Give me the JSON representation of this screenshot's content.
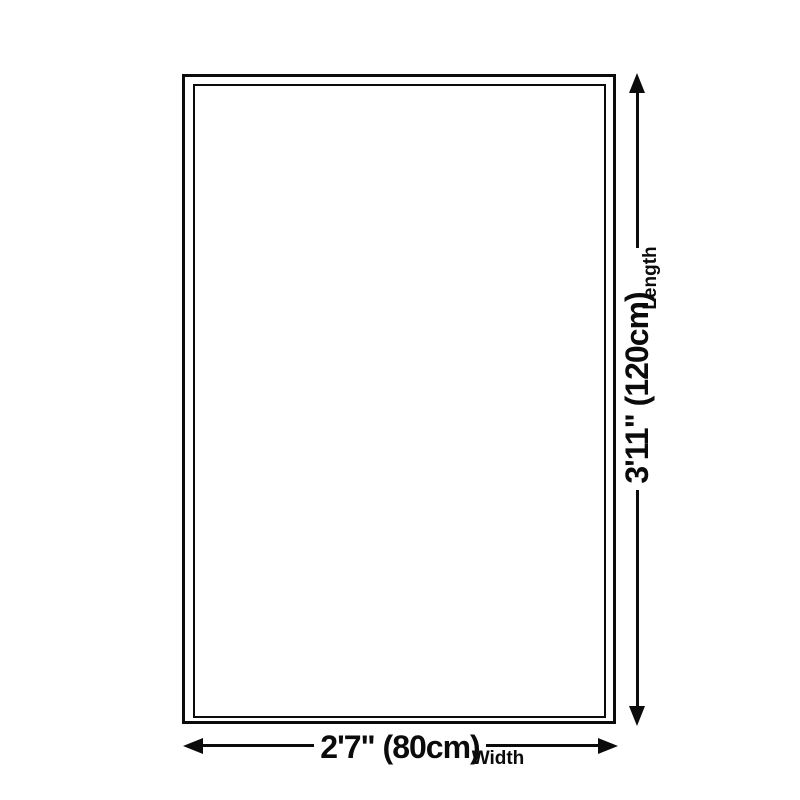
{
  "page": {
    "background_color": "#ffffff",
    "stroke_color": "#0b0b0b"
  },
  "diagram": {
    "type": "product-size-dimension-diagram",
    "outline": {
      "shape": "rectangle",
      "border_style": "double"
    },
    "dimensions": {
      "length": {
        "value": "3'11\" (120cm)",
        "label": "Length",
        "orientation": "vertical",
        "arrow": "double-headed"
      },
      "width": {
        "value": "2'7\" (80cm)",
        "label": "Width",
        "orientation": "horizontal",
        "arrow": "double-headed"
      }
    }
  }
}
